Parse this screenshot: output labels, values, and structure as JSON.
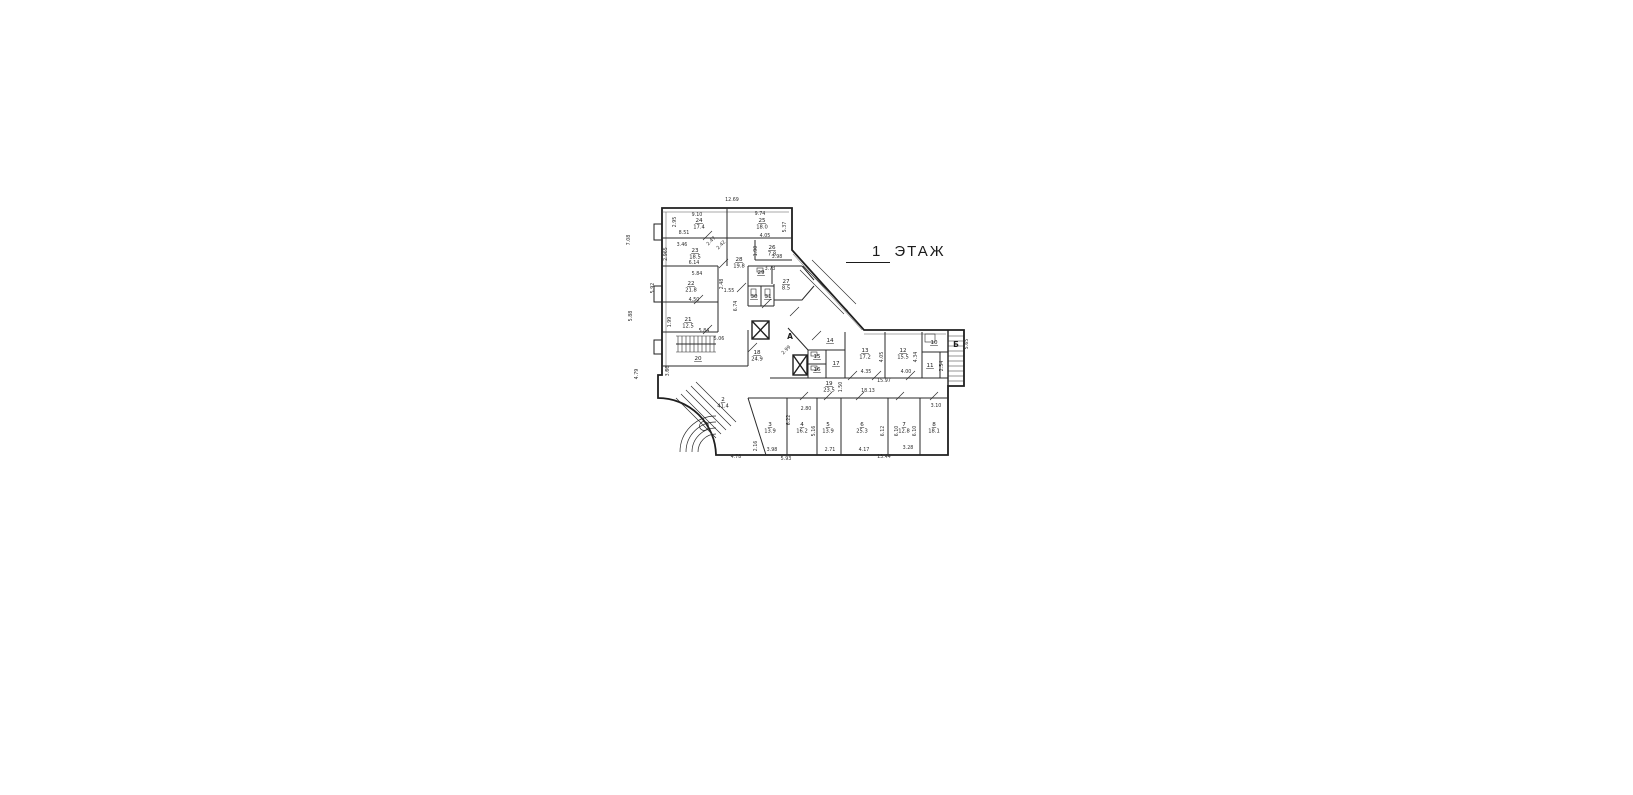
{
  "title": {
    "floor_number": "1",
    "floor_word": "ЭТАЖ"
  },
  "plan": {
    "letters": [
      {
        "text": "А",
        "x": 790,
        "y": 339
      },
      {
        "text": "Б",
        "x": 956,
        "y": 347
      }
    ],
    "rooms": [
      {
        "number": "24",
        "area": "17.4",
        "x": 699,
        "y": 222
      },
      {
        "number": "25",
        "area": "18.0",
        "x": 762,
        "y": 222
      },
      {
        "number": "23",
        "area": "18.5",
        "x": 695,
        "y": 252
      },
      {
        "number": "26",
        "area": "7.8",
        "x": 772,
        "y": 249
      },
      {
        "number": "28",
        "area": "19.8",
        "x": 739,
        "y": 261
      },
      {
        "number": "22",
        "area": "21.8",
        "x": 691,
        "y": 285
      },
      {
        "number": "27",
        "area": "8.5",
        "x": 786,
        "y": 283
      },
      {
        "number": "29",
        "area": "",
        "x": 761,
        "y": 274
      },
      {
        "number": "30",
        "area": "",
        "x": 754,
        "y": 298
      },
      {
        "number": "31",
        "area": "",
        "x": 768,
        "y": 298
      },
      {
        "number": "21",
        "area": "12.5",
        "x": 688,
        "y": 321
      },
      {
        "number": "20",
        "area": "",
        "x": 698,
        "y": 360
      },
      {
        "number": "18",
        "area": "24.9",
        "x": 757,
        "y": 354
      },
      {
        "number": "14",
        "area": "",
        "x": 830,
        "y": 342
      },
      {
        "number": "15",
        "area": "",
        "x": 817,
        "y": 358
      },
      {
        "number": "16",
        "area": "",
        "x": 817,
        "y": 371
      },
      {
        "number": "17",
        "area": "",
        "x": 836,
        "y": 365
      },
      {
        "number": "13",
        "area": "17.2",
        "x": 865,
        "y": 352
      },
      {
        "number": "12",
        "area": "15.5",
        "x": 903,
        "y": 352
      },
      {
        "number": "10",
        "area": "",
        "x": 934,
        "y": 344
      },
      {
        "number": "11",
        "area": "",
        "x": 930,
        "y": 367
      },
      {
        "number": "19",
        "area": "23.5",
        "x": 829,
        "y": 385
      },
      {
        "number": "2",
        "area": "41.4",
        "x": 723,
        "y": 401
      },
      {
        "number": "3",
        "area": "13.9",
        "x": 770,
        "y": 426
      },
      {
        "number": "4",
        "area": "16.2",
        "x": 802,
        "y": 426
      },
      {
        "number": "5",
        "area": "13.9",
        "x": 828,
        "y": 426
      },
      {
        "number": "6",
        "area": "25.3",
        "x": 862,
        "y": 426
      },
      {
        "number": "7",
        "area": "12.8",
        "x": 904,
        "y": 426
      },
      {
        "number": "8",
        "area": "18.1",
        "x": 934,
        "y": 426
      }
    ],
    "dims": [
      {
        "text": "12.69",
        "x": 732,
        "y": 201,
        "rot": 0
      },
      {
        "text": "7.08",
        "x": 630,
        "y": 240,
        "rot": -90
      },
      {
        "text": "5.88",
        "x": 632,
        "y": 316,
        "rot": -90
      },
      {
        "text": "4.79",
        "x": 638,
        "y": 374,
        "rot": -90
      },
      {
        "text": "9.10",
        "x": 697,
        "y": 216,
        "rot": 0
      },
      {
        "text": "2.95",
        "x": 676,
        "y": 222,
        "rot": -90
      },
      {
        "text": "8.51",
        "x": 684,
        "y": 234,
        "rot": 0
      },
      {
        "text": "9.74",
        "x": 760,
        "y": 215,
        "rot": 0
      },
      {
        "text": "5.37",
        "x": 786,
        "y": 227,
        "rot": -90
      },
      {
        "text": "4.05",
        "x": 765,
        "y": 237,
        "rot": 0
      },
      {
        "text": "3.46",
        "x": 682,
        "y": 246,
        "rot": 0
      },
      {
        "text": "2.965",
        "x": 667,
        "y": 254,
        "rot": -90
      },
      {
        "text": "6.14",
        "x": 694,
        "y": 264,
        "rot": 0
      },
      {
        "text": "2.47",
        "x": 712,
        "y": 242,
        "rot": -45
      },
      {
        "text": "2.42",
        "x": 722,
        "y": 246,
        "rot": -45
      },
      {
        "text": "1.90",
        "x": 757,
        "y": 251,
        "rot": -90
      },
      {
        "text": "3.98",
        "x": 777,
        "y": 258,
        "rot": 0
      },
      {
        "text": "3.73",
        "x": 770,
        "y": 270,
        "rot": 0
      },
      {
        "text": "5.84",
        "x": 697,
        "y": 275,
        "rot": 0
      },
      {
        "text": "5.92",
        "x": 654,
        "y": 288,
        "rot": -90
      },
      {
        "text": "2.48",
        "x": 723,
        "y": 284,
        "rot": -90
      },
      {
        "text": "1.55",
        "x": 729,
        "y": 292,
        "rot": 0
      },
      {
        "text": "4.50",
        "x": 694,
        "y": 301,
        "rot": 0
      },
      {
        "text": "6.74",
        "x": 737,
        "y": 306,
        "rot": -90
      },
      {
        "text": "1.99",
        "x": 671,
        "y": 322,
        "rot": -90
      },
      {
        "text": "5.84",
        "x": 704,
        "y": 332,
        "rot": 0
      },
      {
        "text": "5.06",
        "x": 719,
        "y": 340,
        "rot": 0
      },
      {
        "text": "3.66",
        "x": 669,
        "y": 371,
        "rot": -90
      },
      {
        "text": "2.99",
        "x": 787,
        "y": 351,
        "rot": -45
      },
      {
        "text": "1.50",
        "x": 842,
        "y": 387,
        "rot": -90
      },
      {
        "text": "15.97",
        "x": 884,
        "y": 382,
        "rot": 0
      },
      {
        "text": "18.13",
        "x": 868,
        "y": 392,
        "rot": 0
      },
      {
        "text": "4.05",
        "x": 883,
        "y": 357,
        "rot": -90
      },
      {
        "text": "4.35",
        "x": 866,
        "y": 373,
        "rot": 0
      },
      {
        "text": "4.00",
        "x": 906,
        "y": 373,
        "rot": 0
      },
      {
        "text": "4.34",
        "x": 917,
        "y": 357,
        "rot": -90
      },
      {
        "text": "2.54",
        "x": 943,
        "y": 366,
        "rot": -90
      },
      {
        "text": "5.65",
        "x": 968,
        "y": 344,
        "rot": -90
      },
      {
        "text": "3.10",
        "x": 936,
        "y": 407,
        "rot": 0
      },
      {
        "text": "2.80",
        "x": 806,
        "y": 410,
        "rot": 0
      },
      {
        "text": "6.22",
        "x": 790,
        "y": 420,
        "rot": -90
      },
      {
        "text": "5.16",
        "x": 815,
        "y": 431,
        "rot": -90
      },
      {
        "text": "2.16",
        "x": 757,
        "y": 446,
        "rot": -90
      },
      {
        "text": "3.98",
        "x": 772,
        "y": 451,
        "rot": 0
      },
      {
        "text": "2.71",
        "x": 830,
        "y": 451,
        "rot": 0
      },
      {
        "text": "4.17",
        "x": 864,
        "y": 451,
        "rot": 0
      },
      {
        "text": "6.12",
        "x": 884,
        "y": 431,
        "rot": -90
      },
      {
        "text": "6.10",
        "x": 898,
        "y": 431,
        "rot": -90
      },
      {
        "text": "6.10",
        "x": 916,
        "y": 431,
        "rot": -90
      },
      {
        "text": "3.28",
        "x": 908,
        "y": 449,
        "rot": 0
      },
      {
        "text": "4.78",
        "x": 736,
        "y": 458,
        "rot": 0
      },
      {
        "text": "5.93",
        "x": 786,
        "y": 460,
        "rot": 0
      },
      {
        "text": "13.44",
        "x": 884,
        "y": 458,
        "rot": 0
      }
    ]
  }
}
